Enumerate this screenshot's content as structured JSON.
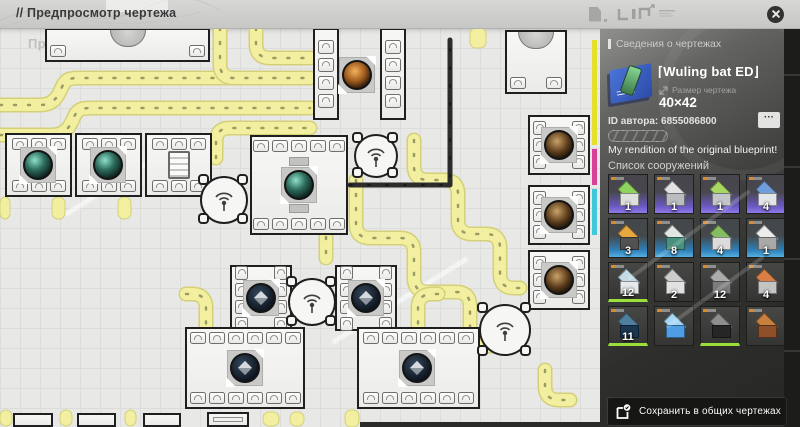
{
  "topbar": {
    "title": "// Предпросмотр чертежа"
  },
  "panel": {
    "section_title": "Сведения о чертежах",
    "name": "⌈Wuling bat ED⌋",
    "size_label": "Размер чертежа",
    "size_value": "40×42",
    "author_id": "ID автора: 6855086800",
    "more_label": "···",
    "description": "My rendition of the original blueprint!",
    "structures_title": "Список сооружений",
    "save_label": "Сохранить в общих чертежах",
    "tiles": [
      {
        "count": "1",
        "accent": "purple",
        "green": false,
        "top": "#8fd45e",
        "body": "#dde0dd"
      },
      {
        "count": "1",
        "accent": "purple",
        "green": false,
        "top": "#e2e2e2",
        "body": "#b9bdc1"
      },
      {
        "count": "1",
        "accent": "purple",
        "green": false,
        "top": "#a8d862",
        "body": "#c2c6ca"
      },
      {
        "count": "4",
        "accent": "purple",
        "green": false,
        "top": "#6f9edb",
        "body": "#e3e6e9"
      },
      {
        "count": "3",
        "accent": "blue",
        "green": false,
        "top": "#e8a73e",
        "body": "#525252"
      },
      {
        "count": "8",
        "accent": "blue",
        "green": false,
        "top": "#e2e6e2",
        "body": "#47917e"
      },
      {
        "count": "4",
        "accent": "blue",
        "green": false,
        "top": "#84bd62",
        "body": "#dcdcdc"
      },
      {
        "count": "1",
        "accent": "blue",
        "green": false,
        "top": "#ececec",
        "body": "#a9a9a9"
      },
      {
        "count": "12",
        "accent": "plain",
        "green": true,
        "top": "#c2dbe6",
        "body": "#e6eaec"
      },
      {
        "count": "2",
        "accent": "plain",
        "green": false,
        "top": "#cccccc",
        "body": "#e2e2e2"
      },
      {
        "count": "12",
        "accent": "plain",
        "green": false,
        "top": "#ababab",
        "body": "#7c7c7c"
      },
      {
        "count": "4",
        "accent": "plain",
        "green": false,
        "top": "#d97f45",
        "body": "#c4c4c4"
      },
      {
        "count": "11",
        "accent": "plain",
        "green": true,
        "top": "#4f7f9e",
        "body": "#1a3650"
      },
      {
        "count": "",
        "accent": "plain",
        "green": false,
        "top": "#a5d8f5",
        "body": "#4f9de2"
      },
      {
        "count": "",
        "accent": "plain",
        "green": true,
        "top": "#8e8e8e",
        "body": "#262626"
      },
      {
        "count": "",
        "accent": "plain",
        "green": false,
        "top": "#c9803f",
        "body": "#8e4f2b"
      }
    ]
  },
  "colors": {
    "belt_fill": "#f2f0a0",
    "belt_edge": "#d3d079",
    "pipe": "#2c2c2c",
    "accent_purple": "#9078e8",
    "accent_blue": "#55b0e0",
    "accent_green": "#9cdf3c"
  },
  "map": {
    "ghost_title": "Предпросмотр чертежа",
    "belts": [
      "M0,77 H40 C54,77 58,68 62,59 C66,50 70,50 84,50 H310",
      "M0,107 H52 C66,107 70,98 74,89 C78,80 82,80 96,80 H310",
      "M216,130 V114 Q216,100 230,100 H310",
      "M220,0 V36 Q220,50 234,50 H310",
      "M256,0 V16 Q256,30 270,30 H310",
      "M356,152 V196 Q356,210 370,210 H400 Q414,210 414,224 V250 Q414,264 428,264 H456 Q470,264 470,278 V304 Q470,318 484,318 H506",
      "M414,112 V138 Q414,152 428,152 H444 Q458,152 458,166 V192 Q458,206 472,206 H486 Q500,206 500,220 V246 Q500,260 514,260 H520",
      "M326,209 V230",
      "M186,266 H192 Q206,266 206,280 V302",
      "M438,266 H432 Q418,266 418,280 V302",
      "M545,342 V358 Q545,372 559,372 H570"
    ],
    "stubs": [
      [
        0,
        169,
        10,
        22
      ],
      [
        52,
        169,
        13,
        22
      ],
      [
        118,
        169,
        13,
        22
      ],
      [
        0,
        382,
        12,
        16
      ],
      [
        60,
        382,
        12,
        16
      ],
      [
        125,
        382,
        11,
        16
      ],
      [
        263,
        384,
        16,
        14
      ],
      [
        290,
        384,
        14,
        14
      ],
      [
        345,
        382,
        14,
        17
      ],
      [
        470,
        0,
        16,
        20
      ]
    ],
    "pipes": [
      "M350,157 H450 V12"
    ],
    "bars": [
      [
        360,
        394,
        240,
        5
      ]
    ],
    "cmyk": [
      [
        12,
        105,
        "#e6df2e"
      ],
      [
        121,
        36,
        "#d84098"
      ],
      [
        161,
        46,
        "#40c8d8"
      ]
    ],
    "buildings": [
      {
        "x": 45,
        "y": 0,
        "w": 165,
        "h": 34,
        "corner": true,
        "dome": true
      },
      {
        "x": 313,
        "y": 0,
        "w": 26,
        "h": 92,
        "col": 4
      },
      {
        "x": 380,
        "y": 0,
        "w": 26,
        "h": 92,
        "col": 4
      },
      {
        "x": 505,
        "y": 2,
        "w": 62,
        "h": 64,
        "corner": true,
        "dome": true
      },
      {
        "x": 250,
        "y": 107,
        "w": 98,
        "h": 100,
        "pt": 5,
        "pb": 5,
        "orb": [
          299,
          157,
          "teal"
        ],
        "ibeam": true
      },
      {
        "x": 5,
        "y": 105,
        "w": 67,
        "h": 64,
        "pt": 3,
        "pb": 3,
        "orb": [
          38,
          137,
          "teal"
        ]
      },
      {
        "x": 75,
        "y": 105,
        "w": 67,
        "h": 64,
        "pt": 3,
        "pb": 3,
        "orb": [
          108,
          137,
          "teal"
        ]
      },
      {
        "x": 145,
        "y": 105,
        "w": 67,
        "h": 64,
        "pt": 3,
        "pb": 3,
        "dev": true
      },
      {
        "x": 528,
        "y": 87,
        "w": 62,
        "h": 60,
        "pl": 3,
        "pr": 3,
        "orb": [
          559,
          117,
          "brown"
        ]
      },
      {
        "x": 528,
        "y": 157,
        "w": 62,
        "h": 60,
        "pl": 3,
        "pr": 3,
        "orb": [
          559,
          187,
          "brown"
        ]
      },
      {
        "x": 528,
        "y": 222,
        "w": 62,
        "h": 60,
        "pl": 3,
        "pr": 3,
        "orb": [
          559,
          252,
          "brown"
        ]
      },
      {
        "x": 230,
        "y": 237,
        "w": 62,
        "h": 66,
        "pl": 4,
        "pr": 4,
        "orb": [
          261,
          270,
          "cube"
        ]
      },
      {
        "x": 335,
        "y": 237,
        "w": 62,
        "h": 66,
        "pl": 4,
        "pr": 4,
        "orb": [
          366,
          270,
          "cube"
        ]
      },
      {
        "x": 185,
        "y": 299,
        "w": 120,
        "h": 82,
        "pt": 6,
        "pb": 6,
        "orb": [
          245,
          340,
          "cube"
        ]
      },
      {
        "x": 357,
        "y": 299,
        "w": 123,
        "h": 82,
        "pt": 6,
        "pb": 6,
        "orb": [
          417,
          340,
          "cube"
        ]
      },
      {
        "x": 13,
        "y": 385,
        "w": 40,
        "h": 14
      },
      {
        "x": 77,
        "y": 385,
        "w": 39,
        "h": 14
      },
      {
        "x": 143,
        "y": 385,
        "w": 38,
        "h": 14
      },
      {
        "x": 207,
        "y": 384,
        "w": 42,
        "h": 15,
        "inner": true
      }
    ],
    "free_orbs": [
      [
        357,
        47,
        "orange"
      ]
    ],
    "radars": [
      [
        224,
        172,
        24
      ],
      [
        376,
        128,
        22
      ],
      [
        312,
        274,
        24
      ],
      [
        505,
        302,
        26
      ]
    ]
  }
}
